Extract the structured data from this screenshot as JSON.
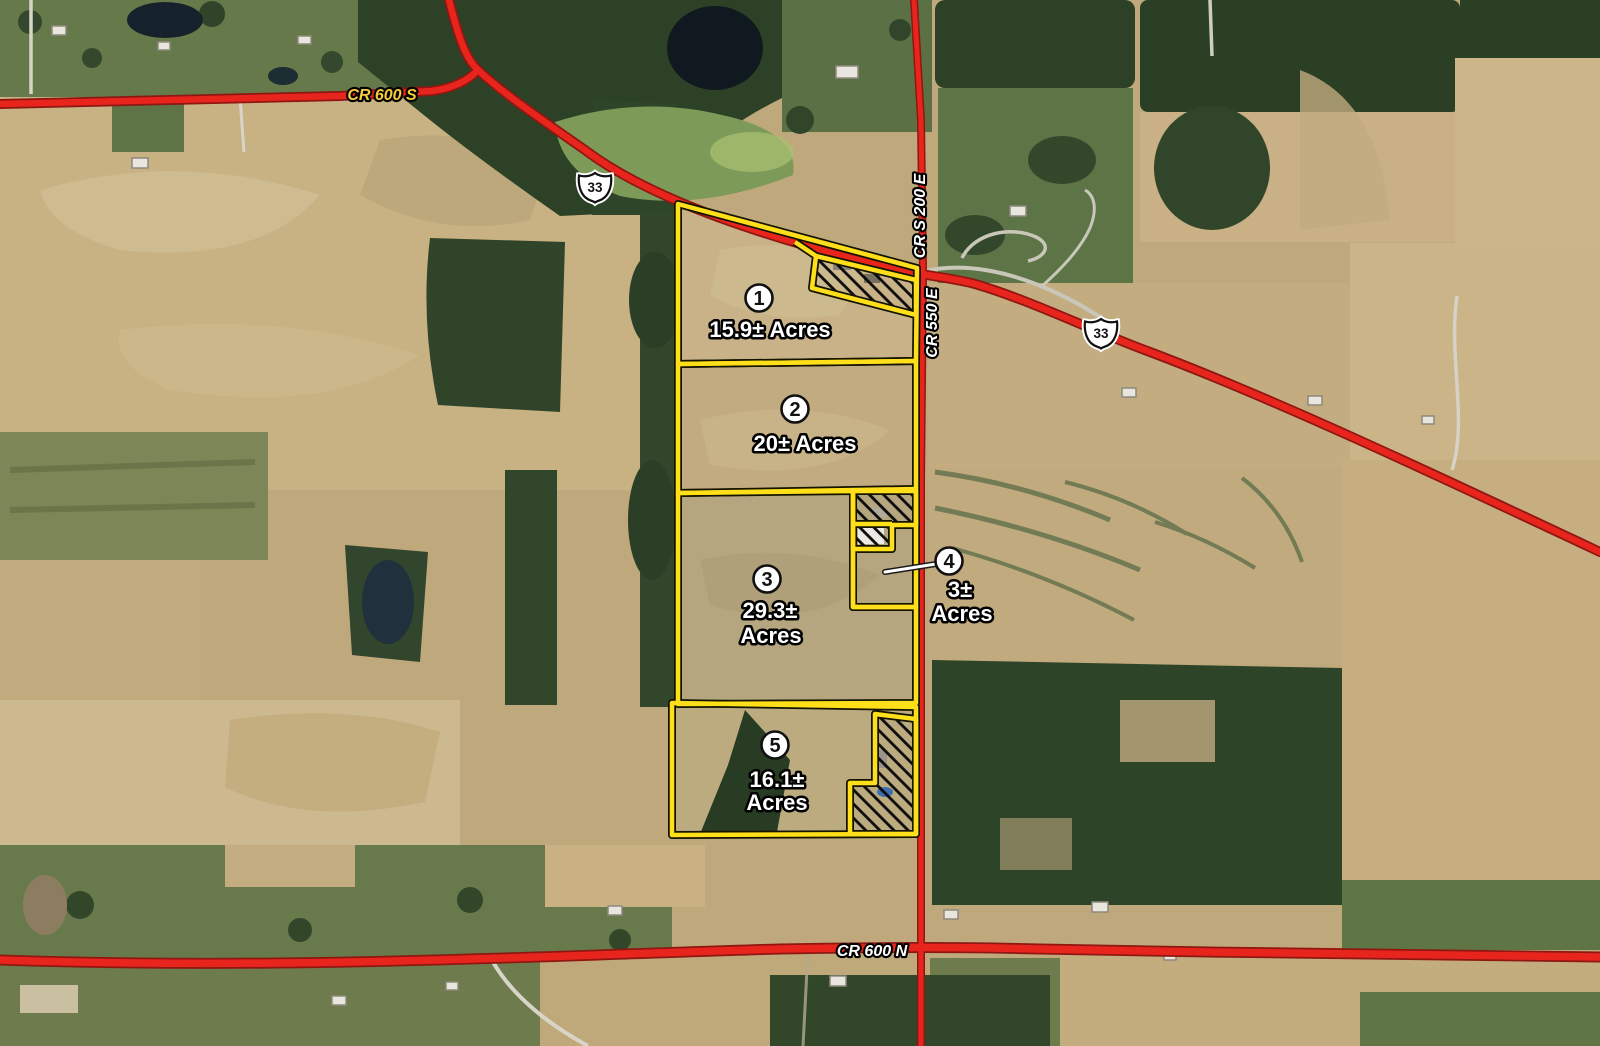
{
  "roads": {
    "cr600s": {
      "label": "CR 600 S"
    },
    "cr600n": {
      "label": "CR 600 N"
    },
    "crs200e": {
      "label": "CR S 200 E"
    },
    "cr550e": {
      "label": "CR 550 E"
    },
    "hwy33": {
      "shield_number": "33"
    }
  },
  "parcels": [
    {
      "number": "1",
      "acreage": "15.9±",
      "label_line1": "15.9± Acres",
      "label_line2": ""
    },
    {
      "number": "2",
      "acreage": "20±",
      "label_line1": "20± Acres",
      "label_line2": ""
    },
    {
      "number": "3",
      "acreage": "29.3±",
      "label_line1": "29.3±",
      "label_line2": "Acres"
    },
    {
      "number": "4",
      "acreage": "3±",
      "label_line1": "3±",
      "label_line2": "Acres"
    },
    {
      "number": "5",
      "acreage": "16.1±",
      "label_line1": "16.1±",
      "label_line2": "Acres"
    }
  ],
  "colors": {
    "parcel_outline": "#ffdf1a",
    "road_red": "#e8251c",
    "label_white": "#ffffff",
    "label_yellow": "#f6cd3a"
  }
}
